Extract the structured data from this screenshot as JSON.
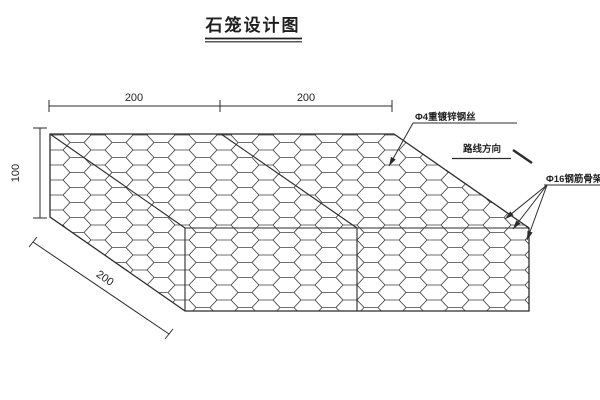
{
  "title": "石笼设计图",
  "dimensions": {
    "top_left_segment": "200",
    "top_right_segment": "200",
    "height": "100",
    "depth": "200"
  },
  "annotations": {
    "mesh_wire": "Φ4重镀锌钢丝",
    "route_direction": "路线方向",
    "frame": "Φ16钢筋骨架"
  },
  "colors": {
    "line": "#2b2b2b",
    "mesh": "#404040",
    "background": "#ffffff"
  }
}
